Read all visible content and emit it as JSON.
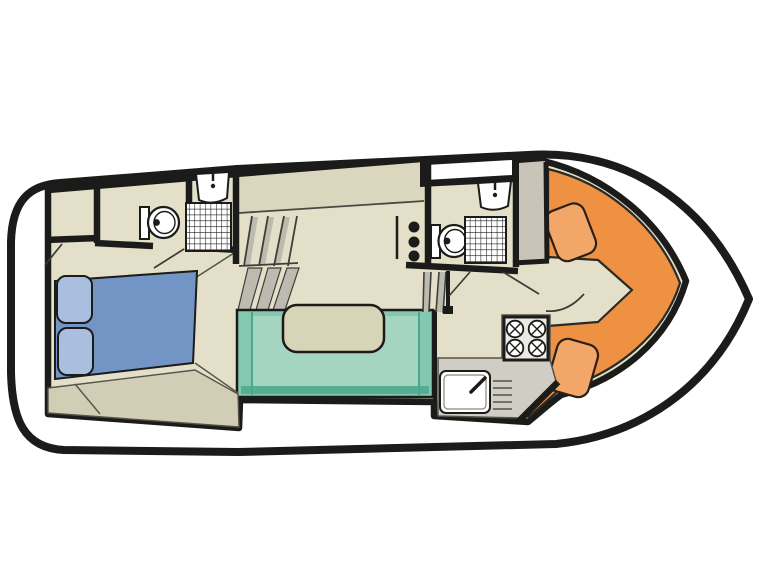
{
  "figure": {
    "type": "boat-floor-plan",
    "view": "top-down deck plan, bow pointing right, stern at left"
  },
  "palette": {
    "background": "#ffffff",
    "hull_fill": "#ffffff",
    "wall": "#1b1b19",
    "floor": "#e3dfc8",
    "floor_band": "#dbd7bf",
    "bench": "#d2ceb6",
    "counter_gray": "#d0cdc4",
    "cabinet_gray": "#c8c5b8",
    "stove_plate": "#eceae4",
    "fixture_white": "#ffffff",
    "bed_blue": "#7295c6",
    "pillow_blue": "#aabfe0",
    "sofa_teal": "#85c8b0",
    "sofa_teal_light": "#a3d5c0",
    "sofa_teal_dark": "#55ad92",
    "table_beige": "#d8d4b8",
    "dinette_orange": "#ef9143",
    "cushion_orange": "#f2a768",
    "stair_gray": "#bdbab0",
    "line_dark": "#4a4840"
  },
  "areas": {
    "aft_cabin": "double-berth cabin with bench",
    "aft_bathroom": "toilet, washbasin, shower",
    "closet": "hanging locker",
    "stairs": "companionway steps",
    "salon": "U-shaped settee with table and sideboard",
    "mid_bathroom": "toilet, washbasin, shower",
    "wardrobe": "locker",
    "galley": "four-burner stove and sink with drainer",
    "bow_dinette": "V-shaped orange seating with two cushions",
    "foredeck": "open deck inside hull outline"
  }
}
